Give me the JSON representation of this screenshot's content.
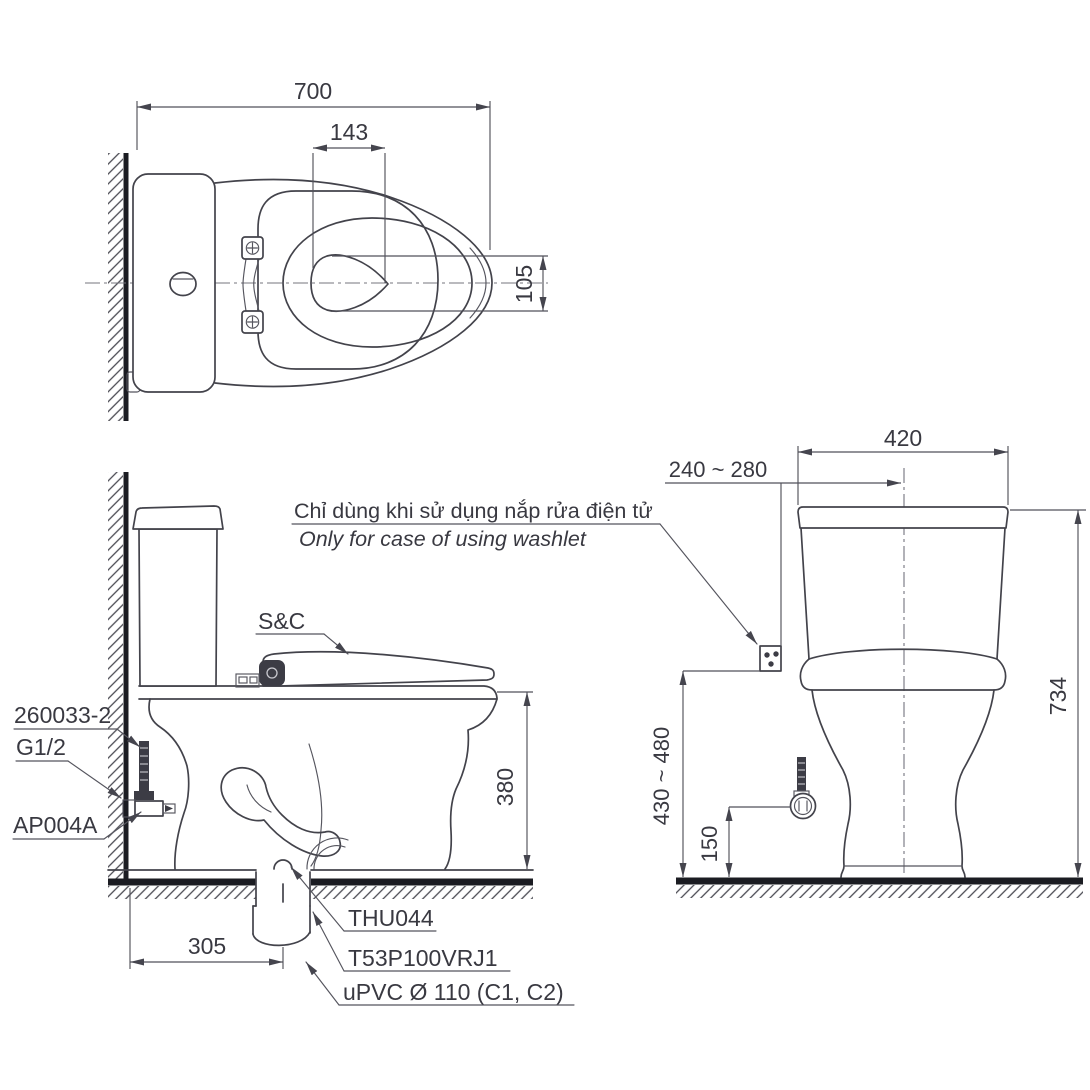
{
  "note": {
    "vietnamese": "Chỉ dùng khi sử dụng nắp rửa điện tử",
    "english": "Only for case of using washlet"
  },
  "top_view": {
    "overall_length": "700",
    "water_surface_width": "143",
    "water_surface_depth": "105"
  },
  "front_view": {
    "rim_height": "380",
    "outlet_center_from_wall": "305",
    "labels": {
      "supply_hose": "260033-2",
      "thread_size": "G1/2",
      "angle_valve": "AP004A",
      "washlet_seat": "S&C",
      "outlet_flange": "THU044",
      "model_code": "T53P100VRJ1",
      "drain_pipe": "uPVC Ø 110 (C1, C2)"
    }
  },
  "side_view": {
    "tank_width": "420",
    "supply_from_center": "240 ~ 280",
    "overall_height": "734",
    "socket_height": "430 ~ 480",
    "valve_height": "150"
  },
  "colors": {
    "line": "#43434b",
    "dimension": "#52525b",
    "text": "#393941",
    "heavy": "#1b1c22",
    "background": "#ffffff"
  }
}
